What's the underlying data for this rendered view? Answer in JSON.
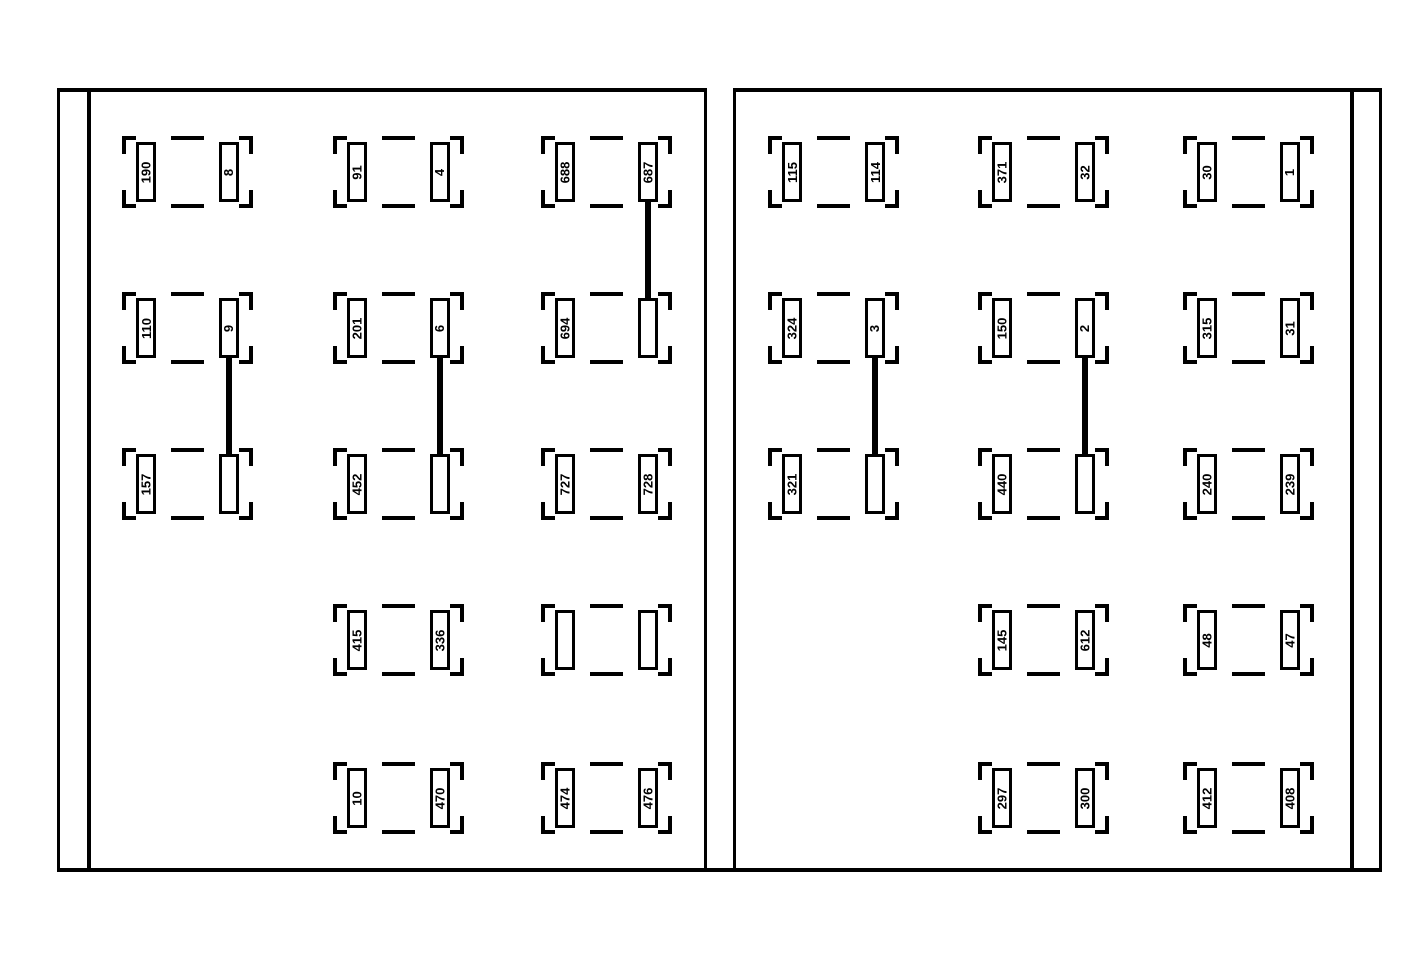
{
  "diagram": {
    "type": "fuse-box-connector-diagram",
    "colors": {
      "line": "#000000",
      "background": "#ffffff"
    },
    "panels": [
      {
        "name": "left",
        "units": [
          {
            "row": 0,
            "col": 0,
            "slots": [
              "190",
              "8"
            ]
          },
          {
            "row": 0,
            "col": 1,
            "slots": [
              "91",
              "4"
            ]
          },
          {
            "row": 0,
            "col": 2,
            "slots": [
              "688",
              "687"
            ]
          },
          {
            "row": 1,
            "col": 0,
            "slots": [
              "110",
              "9"
            ]
          },
          {
            "row": 1,
            "col": 1,
            "slots": [
              "201",
              "6"
            ]
          },
          {
            "row": 1,
            "col": 2,
            "slots": [
              "694",
              ""
            ]
          },
          {
            "row": 2,
            "col": 0,
            "slots": [
              "157",
              ""
            ]
          },
          {
            "row": 2,
            "col": 1,
            "slots": [
              "452",
              ""
            ]
          },
          {
            "row": 2,
            "col": 2,
            "slots": [
              "727",
              "728"
            ]
          },
          {
            "row": 3,
            "col": 1,
            "slots": [
              "415",
              "336"
            ]
          },
          {
            "row": 3,
            "col": 2,
            "slots": [
              "",
              ""
            ]
          },
          {
            "row": 4,
            "col": 1,
            "slots": [
              "10",
              "470"
            ]
          },
          {
            "row": 4,
            "col": 2,
            "slots": [
              "474",
              "476"
            ]
          }
        ],
        "connectors": [
          {
            "col": 2,
            "from_row": 0,
            "to_row": 1
          },
          {
            "col": 0,
            "from_row": 1,
            "to_row": 2
          },
          {
            "col": 1,
            "from_row": 1,
            "to_row": 2
          }
        ]
      },
      {
        "name": "right",
        "units": [
          {
            "row": 0,
            "col": 0,
            "slots": [
              "115",
              "114"
            ]
          },
          {
            "row": 0,
            "col": 1,
            "slots": [
              "371",
              "32"
            ]
          },
          {
            "row": 0,
            "col": 2,
            "slots": [
              "30",
              "1"
            ]
          },
          {
            "row": 1,
            "col": 0,
            "slots": [
              "324",
              "3"
            ]
          },
          {
            "row": 1,
            "col": 1,
            "slots": [
              "150",
              "2"
            ]
          },
          {
            "row": 1,
            "col": 2,
            "slots": [
              "315",
              "31"
            ]
          },
          {
            "row": 2,
            "col": 0,
            "slots": [
              "321",
              ""
            ]
          },
          {
            "row": 2,
            "col": 1,
            "slots": [
              "440",
              ""
            ]
          },
          {
            "row": 2,
            "col": 2,
            "slots": [
              "240",
              "239"
            ]
          },
          {
            "row": 3,
            "col": 1,
            "slots": [
              "145",
              "612"
            ]
          },
          {
            "row": 3,
            "col": 2,
            "slots": [
              "48",
              "47"
            ]
          },
          {
            "row": 4,
            "col": 1,
            "slots": [
              "297",
              "300"
            ]
          },
          {
            "row": 4,
            "col": 2,
            "slots": [
              "412",
              "408"
            ]
          }
        ],
        "connectors": [
          {
            "col": 0,
            "from_row": 1,
            "to_row": 2
          },
          {
            "col": 1,
            "from_row": 1,
            "to_row": 2
          }
        ]
      }
    ]
  }
}
